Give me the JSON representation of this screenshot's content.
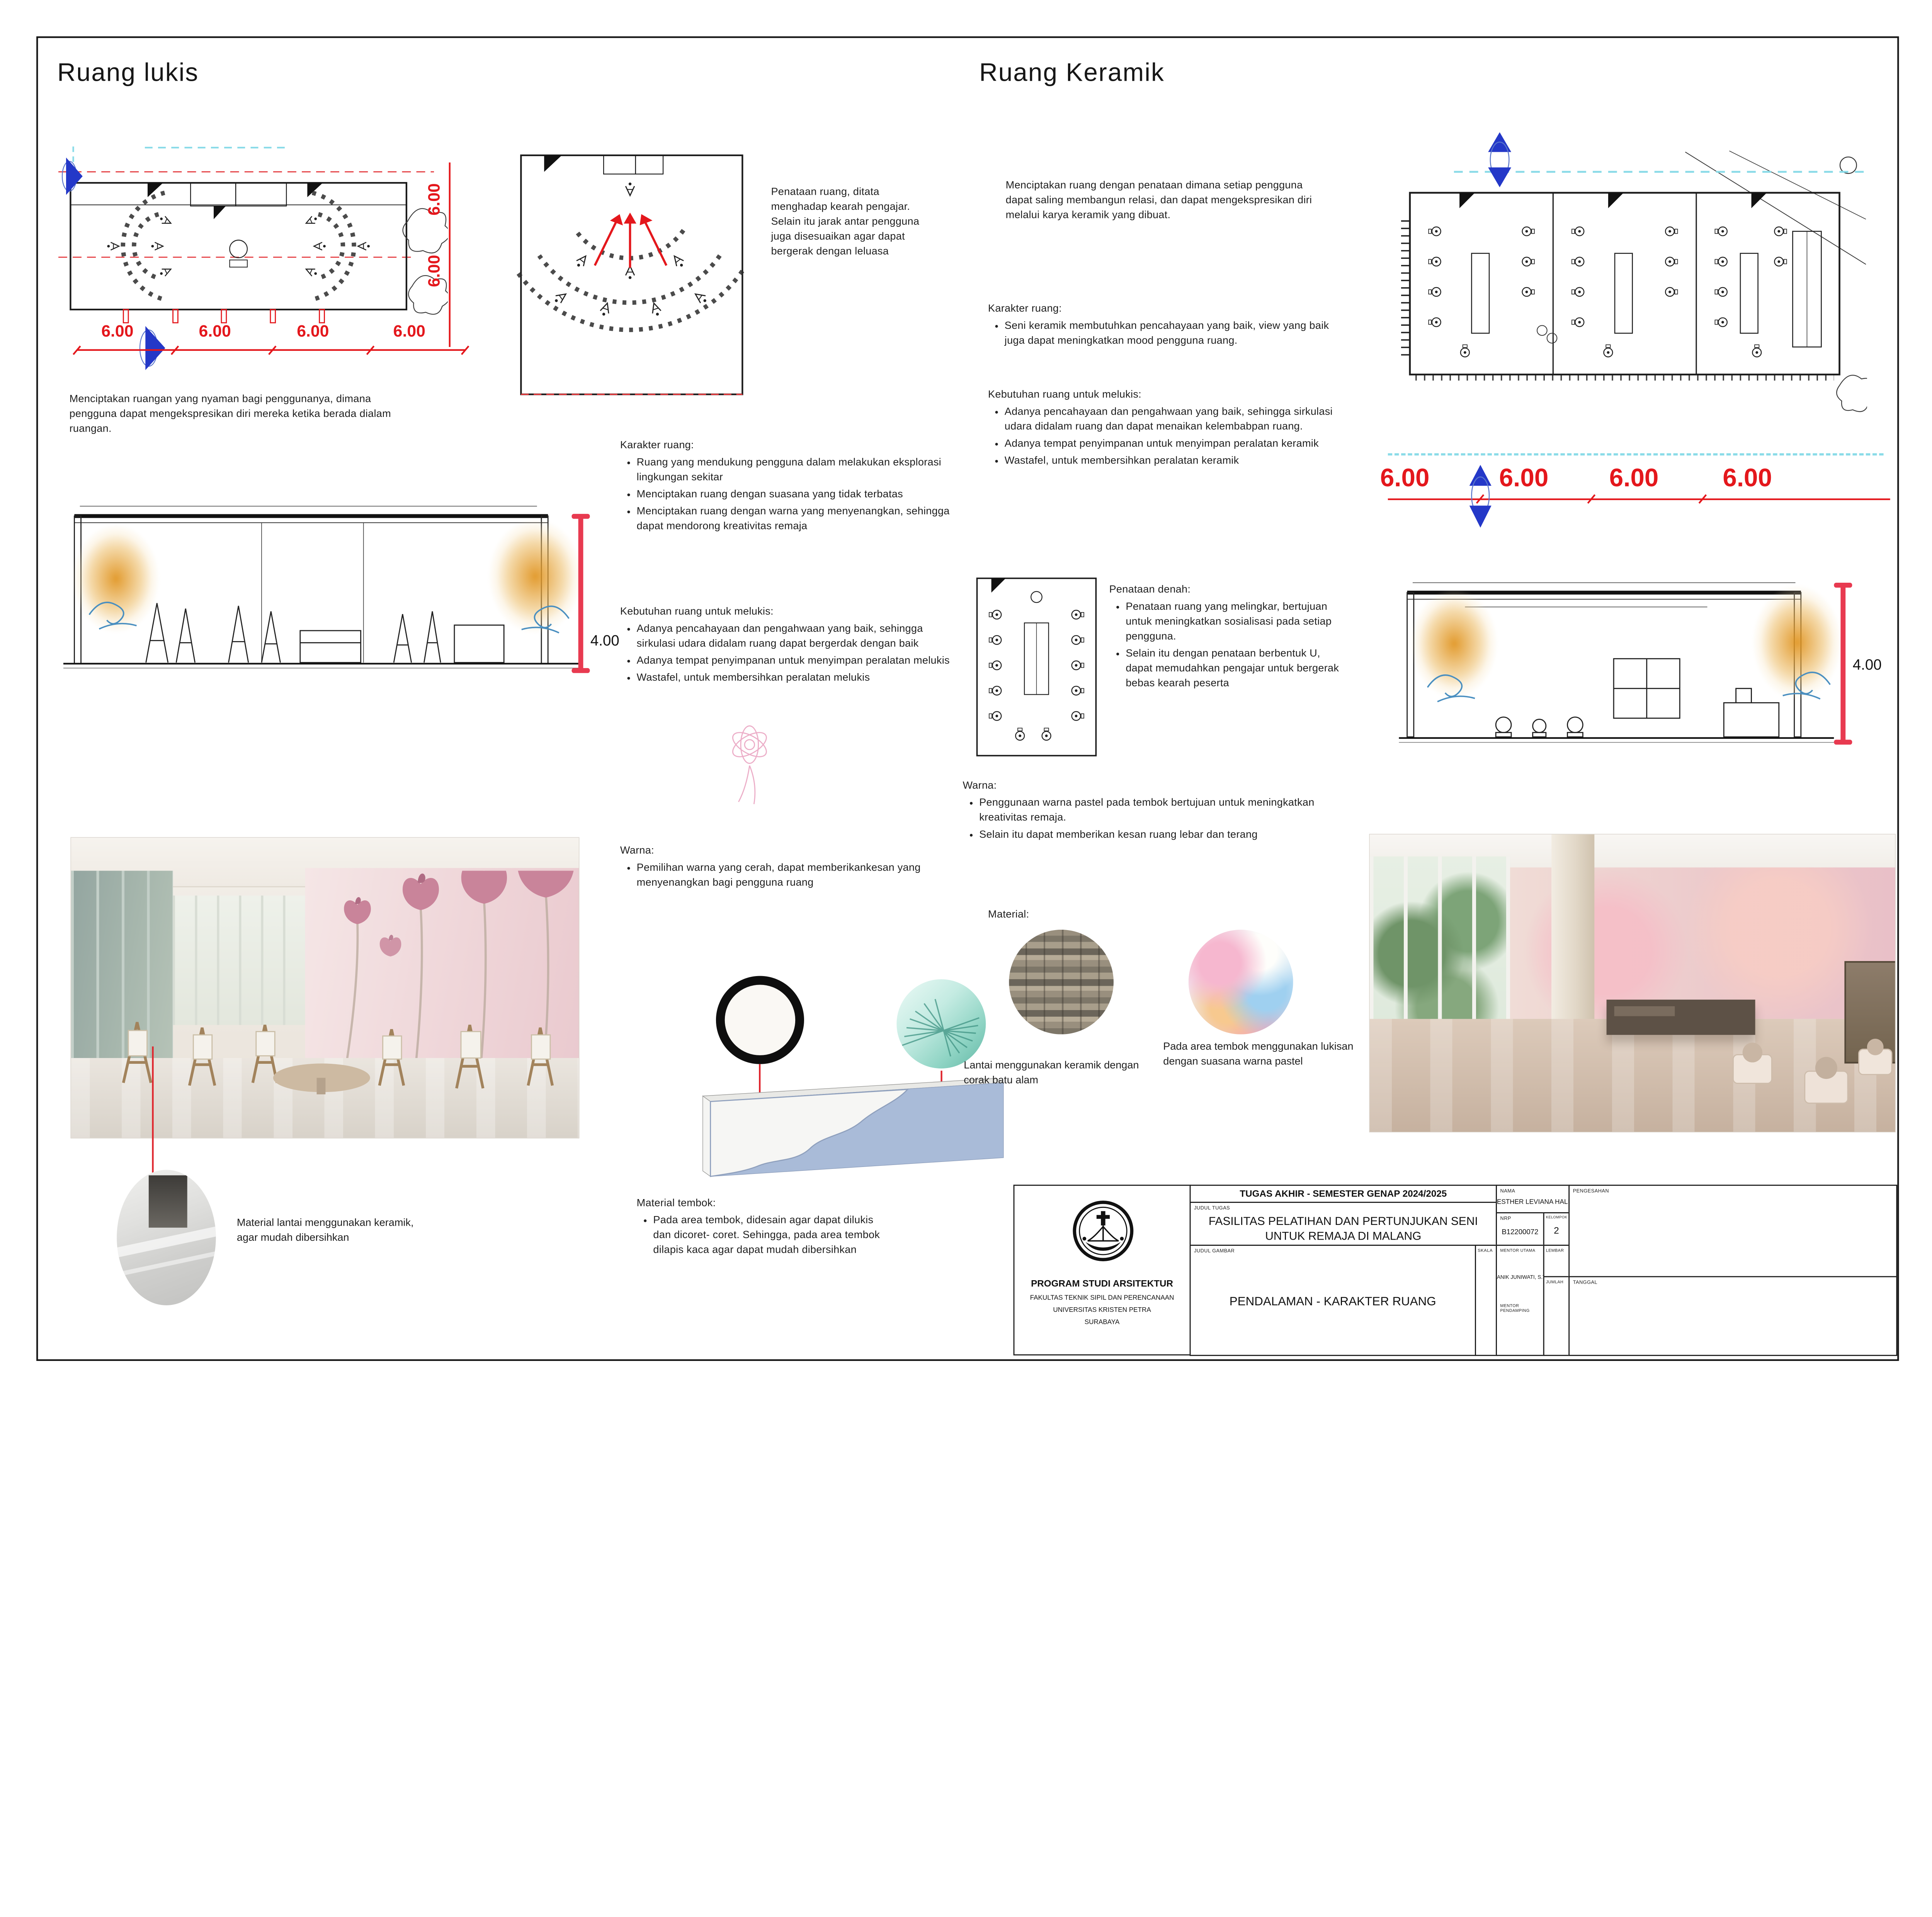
{
  "left": {
    "title": "Ruang lukis",
    "intro": "Menciptakan ruangan yang nyaman bagi penggunanya, dimana pengguna dapat mengekspresikan diri mereka ketika berada dialam ruangan.",
    "plan_note": "Penataan ruang, ditata menghadap kearah pengajar. Selain itu jarak antar pengguna juga disesuaikan agar dapat bergerak dengan leluasa",
    "karakter_heading": "Karakter ruang:",
    "karakter_items": [
      "Ruang yang mendukung pengguna dalam melakukan eksplorasi lingkungan sekitar",
      "Menciptakan ruang dengan suasana yang tidak terbatas",
      "Menciptakan ruang dengan warna yang menyenangkan, sehingga dapat mendorong kreativitas remaja"
    ],
    "kebutuhan_heading": "Kebutuhan ruang untuk melukis:",
    "kebutuhan_items": [
      "Adanya pencahayaan dan pengahwaan yang baik, sehingga sirkulasi udara didalam ruang dapat bergerdak dengan baik",
      "Adanya tempat penyimpanan untuk menyimpan peralatan melukis",
      "Wastafel, untuk membersihkan peralatan melukis"
    ],
    "warna_heading": "Warna:",
    "warna_items": [
      "Pemilihan warna yang cerah, dapat memberikankesan yang menyenangkan bagi pengguna ruang"
    ],
    "material_tembok_heading": "Material tembok:",
    "material_tembok_items": [
      "Pada area tembok, didesain agar dapat dilukis dan dicoret- coret. Sehingga, pada area tembok dilapis kaca agar dapat mudah dibersihkan"
    ],
    "material_lantai_caption": "Material lantai menggunakan keramik, agar mudah dibersihkan"
  },
  "right": {
    "title": "Ruang Keramik",
    "intro": "Menciptakan ruang dengan penataan dimana setiap pengguna dapat saling membangun relasi, dan dapat mengekspresikan diri melalui karya keramik yang dibuat.",
    "karakter_heading": "Karakter ruang:",
    "karakter_items": [
      "Seni keramik membutuhkan pencahayaan yang baik, view yang baik juga dapat meningkatkan mood pengguna ruang."
    ],
    "kebutuhan_heading": "Kebutuhan ruang untuk melukis:",
    "kebutuhan_items": [
      "Adanya pencahayaan dan pengahwaan yang baik, sehingga sirkulasi udara didalam ruang dan dapat menaikan kelembabpan ruang.",
      "Adanya tempat penyimpanan untuk menyimpan peralatan keramik",
      "Wastafel, untuk membersihkan peralatan keramik"
    ],
    "penataan_heading": "Penataan denah:",
    "penataan_items": [
      "Penataan ruang yang melingkar, bertujuan untuk meningkatkan sosialisasi pada setiap pengguna.",
      "Selain itu dengan penataan berbentuk U, dapat memudahkan pengajar untuk bergerak bebas kearah peserta"
    ],
    "warna_heading": "Warna:",
    "warna_items": [
      "Penggunaan warna pastel pada tembok bertujuan untuk meningkatkan kreativitas remaja.",
      "Selain itu dapat memberikan kesan ruang lebar dan terang"
    ],
    "material_heading": "Material:",
    "material_lantai_caption": "Lantai menggunakan keramik dengan corak batu alam",
    "material_tembok_caption": "Pada area tembok menggunakan lukisan dengan suasana warna pastel"
  },
  "dimensions": {
    "left_plan_bottom": [
      "6.00",
      "6.00",
      "6.00",
      "6.00"
    ],
    "left_plan_side": [
      "6.00",
      "6.00"
    ],
    "left_section_height": "4.00",
    "right_plan_bottom": [
      "6.00",
      "6.00",
      "6.00",
      "6.00"
    ],
    "right_section_height": "4.00"
  },
  "titleblock": {
    "header": "TUGAS AKHIR - SEMESTER GENAP 2024/2025",
    "labels": {
      "judul_tugas": "JUDUL TUGAS",
      "judul_gambar": "JUDUL GAMBAR",
      "skala": "SKALA",
      "nama": "NAMA",
      "nrp": "NRP",
      "kelompok": "KELOMPOK",
      "mentor_utama": "MENTOR UTAMA",
      "mentor_pendamping": "MENTOR PENDAMPING",
      "lembar": "LEMBAR",
      "jumlah": "JUMLAH",
      "tanggal": "TANGGAL",
      "pengesahan": "PENGESAHAN"
    },
    "judul_tugas_value": "FASILITAS PELATIHAN DAN PERTUNJUKAN SENI UNTUK REMAJA DI MALANG",
    "judul_gambar_value": "PENDALAMAN - KARAKTER RUANG",
    "nama_value": "ESTHER LEVIANA HALIM P.",
    "nrp_value": "B12200072",
    "kelompok_value": "2",
    "mentor_utama_value": "ANIK JUNIWATI, S.T., M.T",
    "institution": [
      "PROGRAM STUDI ARSITEKTUR",
      "FAKULTAS TEKNIK SIPIL DAN PERENCANAAN",
      "UNIVERSITAS KRISTEN PETRA",
      "SURABAYA"
    ]
  },
  "colors": {
    "dimension_red": "#e4171c",
    "section_dim_red": "#e83a50",
    "section_marker_blue": "#2742c8",
    "cyan_guide": "#8adbe8",
    "wall_panel_blue": "#a9bbd8"
  }
}
